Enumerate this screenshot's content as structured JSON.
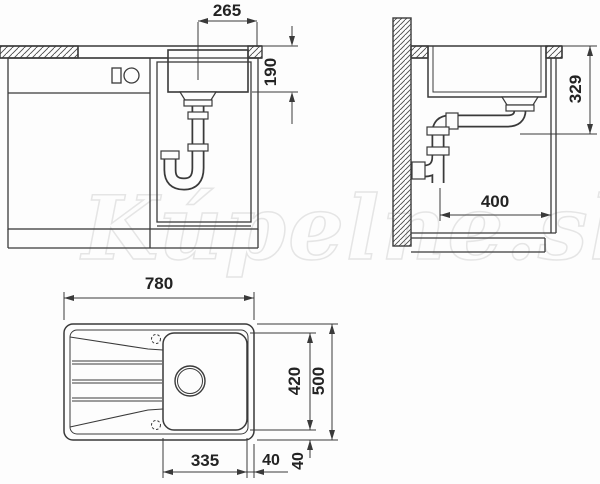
{
  "watermark_text": "Kúpelne.sk",
  "dimensions": {
    "front_view": {
      "basin_width_mm": "265",
      "basin_depth_mm": "190"
    },
    "side_view": {
      "outlet_height_mm": "329",
      "clearance_depth_mm": "400"
    },
    "top_view": {
      "overall_width_mm": "780",
      "bowl_length_mm": "420",
      "overall_depth_mm": "500",
      "bowl_width_mm": "335",
      "side_margin_mm": "40",
      "front_margin_mm": "40"
    }
  }
}
